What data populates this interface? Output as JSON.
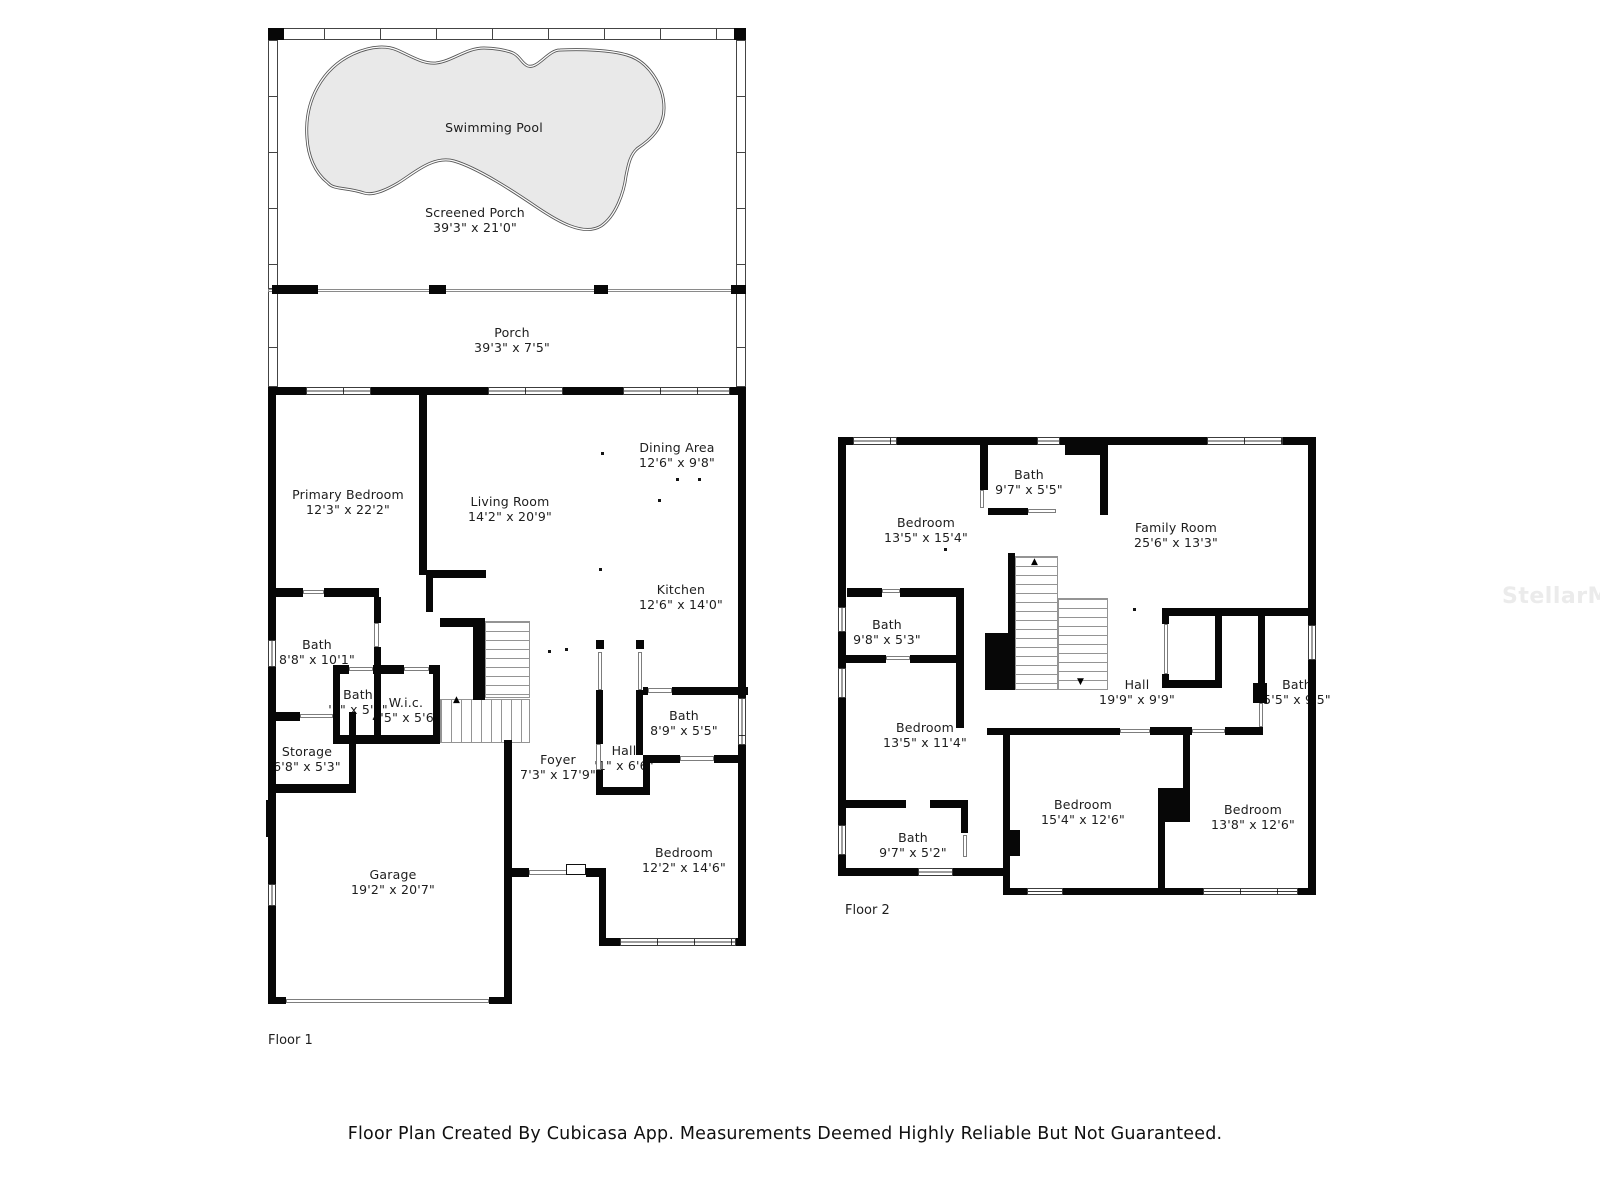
{
  "floor1": {
    "label": "Floor 1",
    "rooms": {
      "swimming_pool": {
        "name": "Swimming Pool",
        "dims": ""
      },
      "screened_porch": {
        "name": "Screened Porch",
        "dims": "39'3\" x 21'0\""
      },
      "porch": {
        "name": "Porch",
        "dims": "39'3\" x 7'5\""
      },
      "primary_bedroom": {
        "name": "Primary Bedroom",
        "dims": "12'3\" x 22'2\""
      },
      "living_room": {
        "name": "Living Room",
        "dims": "14'2\" x 20'9\""
      },
      "dining_area": {
        "name": "Dining Area",
        "dims": "12'6\" x 9'8\""
      },
      "kitchen": {
        "name": "Kitchen",
        "dims": "12'6\" x 14'0\""
      },
      "bath": {
        "name": "Bath",
        "dims": "8'8\" x 10'1\""
      },
      "bath_2": {
        "name": "Bath",
        "dims": "'1\" x 5'6\""
      },
      "wic": {
        "name": "W.i.c.",
        "dims": "4'5\" x 5'6\""
      },
      "storage": {
        "name": "Storage",
        "dims": "6'8\" x 5'3\""
      },
      "garage": {
        "name": "Garage",
        "dims": "19'2\" x 20'7\""
      },
      "foyer": {
        "name": "Foyer",
        "dims": "7'3\" x 17'9\""
      },
      "hall": {
        "name": "Hall",
        "dims": "'1\" x 6'6\""
      },
      "bath_3": {
        "name": "Bath",
        "dims": "8'9\" x 5'5\""
      },
      "bedroom": {
        "name": "Bedroom",
        "dims": "12'2\" x 14'6\""
      }
    }
  },
  "floor2": {
    "label": "Floor 2",
    "rooms": {
      "bath": {
        "name": "Bath",
        "dims": "9'7\" x 5'5\""
      },
      "bedroom": {
        "name": "Bedroom",
        "dims": "13'5\" x 15'4\""
      },
      "family_room": {
        "name": "Family Room",
        "dims": "25'6\" x 13'3\""
      },
      "bath_2": {
        "name": "Bath",
        "dims": "9'8\" x 5'3\""
      },
      "bedroom_2": {
        "name": "Bedroom",
        "dims": "13'5\" x 11'4\""
      },
      "hall": {
        "name": "Hall",
        "dims": "19'9\" x 9'9\""
      },
      "bath_3": {
        "name": "Bath",
        "dims": "5'5\" x 9'5\""
      },
      "bath_4": {
        "name": "Bath",
        "dims": "9'7\" x 5'2\""
      },
      "bedroom_3": {
        "name": "Bedroom",
        "dims": "15'4\" x 12'6\""
      },
      "bedroom_4": {
        "name": "Bedroom",
        "dims": "13'8\" x 12'6\""
      }
    }
  },
  "footer": {
    "caption": "Floor Plan Created By Cubicasa App. Measurements Deemed Highly Reliable But Not Guaranteed."
  },
  "watermark": {
    "text": "StellarMLS"
  },
  "colors": {
    "wall": "#070707",
    "pool_fill": "#e9e9e9",
    "text": "#1d1d1d",
    "watermark": "#ebebeb"
  }
}
